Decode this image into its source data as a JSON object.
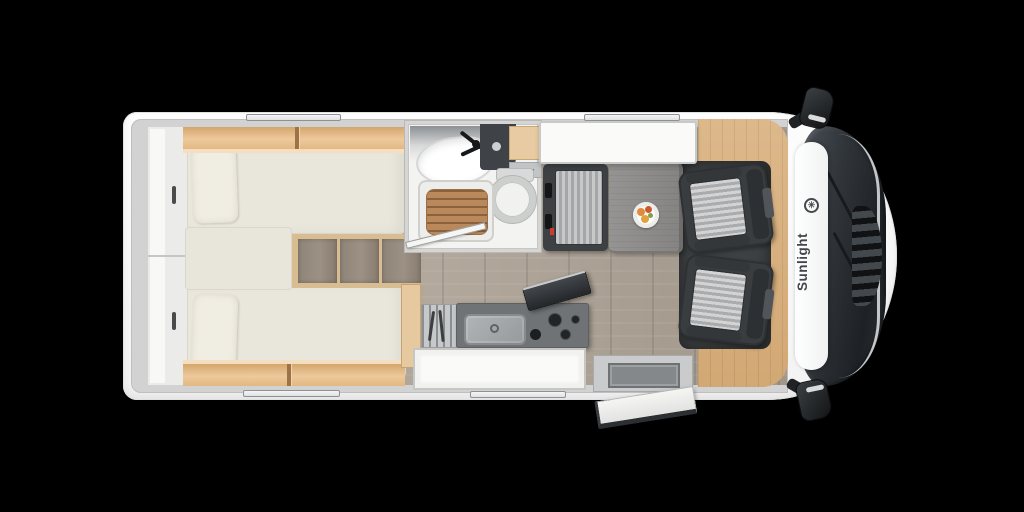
{
  "brand": {
    "name": "Sunlight",
    "logo_glyph": "✳"
  },
  "colors": {
    "background": "#000000",
    "walls": "#d2d2d3",
    "floor": "#a89e92",
    "bed": "#e9e6db",
    "pillow": "#f0ede3",
    "step_wood": "#d9bd92",
    "shower_wood": "#b9895c",
    "seat_dark": "#3e4144",
    "seat_stripe_light": "#c7c8c9",
    "seat_stripe_dark": "#a4a6a7",
    "counter_dark": "#6f7376",
    "stainless": "#b0b4b6",
    "mat": "#3e4143",
    "windshield": "#1e2125",
    "brand_text": "#42464a",
    "accent_red": "#cf3b2f"
  },
  "furniture": [
    "rear-wardrobe",
    "twin-bed-top",
    "twin-bed-bottom",
    "bed-steps",
    "overhead-lockers",
    "bathroom-sink",
    "toilet",
    "shower",
    "bathroom-door",
    "dinette-bench",
    "dinette-table",
    "overhead-shelf",
    "kitchen-counter",
    "kitchen-sink",
    "hob",
    "entry-door",
    "entry-step",
    "cab-seat-passenger",
    "cab-seat-driver",
    "windshield",
    "side-mirror"
  ]
}
